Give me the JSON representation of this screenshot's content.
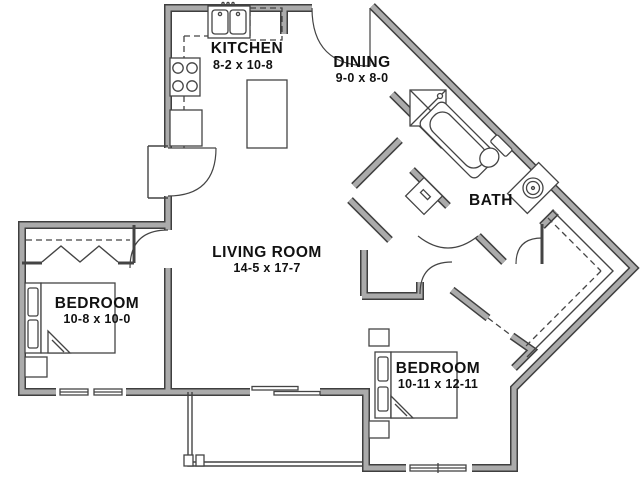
{
  "plan": {
    "title": "Two Bedroom Apartment Floor Plan",
    "rooms": {
      "kitchen": {
        "name": "KITCHEN",
        "dims": "8-2 x 10-8"
      },
      "dining": {
        "name": "DINING",
        "dims": "9-0 x 8-0"
      },
      "living_room": {
        "name": "LIVING ROOM",
        "dims": "14-5 x 17-7"
      },
      "bath": {
        "name": "BATH"
      },
      "bedroom_left": {
        "name": "BEDROOM",
        "dims": "10-8 x 10-0"
      },
      "bedroom_right": {
        "name": "BEDROOM",
        "dims": "10-11 x 12-11"
      }
    },
    "colors": {
      "background": "#ffffff",
      "wall_edge": "#3f3f3f",
      "wall_fill": "#ababab",
      "line": "#444444",
      "text": "#111111"
    }
  }
}
